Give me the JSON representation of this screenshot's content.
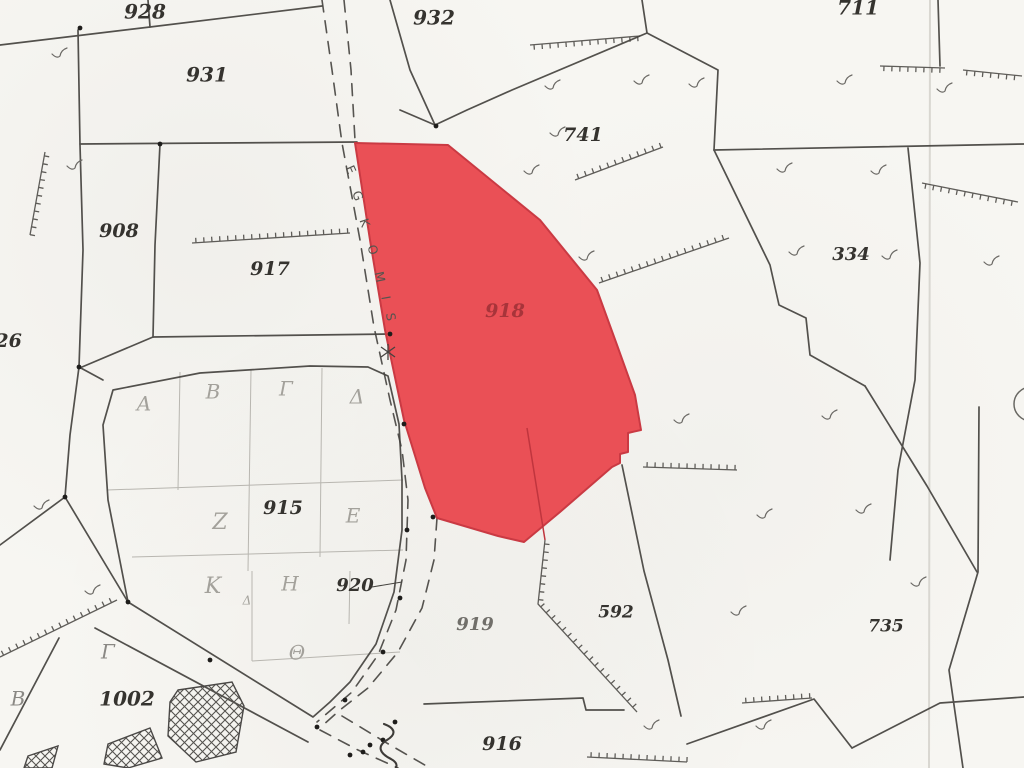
{
  "map": {
    "width": 1024,
    "height": 768,
    "colors": {
      "paper": "#f7f6f2",
      "line": "#45433f",
      "faint": "#b8b6b0",
      "red_fill": "#ea4b52",
      "red_stroke": "#c9353e",
      "red_label": "#a8343a",
      "greek": "#a3a19b",
      "greek_dark": "#8a8884",
      "road_text": "#56544f",
      "fold": "#d9d7d1",
      "mark": "#6b6965",
      "monument": "#1e1d1b"
    },
    "fold_x": 930,
    "highlight": {
      "label": "918",
      "label_pos": [
        505,
        312
      ],
      "points": [
        [
          355,
          143
        ],
        [
          448,
          145
        ],
        [
          540,
          220
        ],
        [
          597,
          290
        ],
        [
          617,
          345
        ],
        [
          635,
          395
        ],
        [
          641,
          430
        ],
        [
          628,
          433
        ],
        [
          628,
          452
        ],
        [
          620,
          454
        ],
        [
          620,
          463
        ],
        [
          612,
          467
        ],
        [
          560,
          512
        ],
        [
          524,
          542
        ],
        [
          498,
          536
        ],
        [
          437,
          518
        ],
        [
          425,
          488
        ],
        [
          404,
          420
        ],
        [
          385,
          330
        ],
        [
          370,
          240
        ]
      ],
      "inner_line": [
        [
          527,
          428
        ],
        [
          545,
          540
        ]
      ]
    },
    "road_name": {
      "text": "EGKOMIS",
      "letters": [
        [
          "E",
          350,
          170,
          66
        ],
        [
          "G",
          357,
          196,
          69
        ],
        [
          "K",
          364,
          223,
          72
        ],
        [
          "O",
          372,
          250,
          75
        ],
        [
          "M",
          379,
          277,
          78
        ],
        [
          "I",
          385,
          298,
          80
        ],
        [
          "S",
          390,
          317,
          82
        ]
      ]
    },
    "labels": [
      {
        "t": "928",
        "x": 145,
        "y": 13,
        "s": 20
      },
      {
        "t": "931",
        "x": 207,
        "y": 76,
        "s": 20
      },
      {
        "t": "932",
        "x": 434,
        "y": 19,
        "s": 20
      },
      {
        "t": "711",
        "x": 858,
        "y": 9,
        "s": 20
      },
      {
        "t": "741",
        "x": 583,
        "y": 136,
        "s": 19
      },
      {
        "t": "334",
        "x": 851,
        "y": 255,
        "s": 18
      },
      {
        "t": "908",
        "x": 119,
        "y": 232,
        "s": 19
      },
      {
        "t": "917",
        "x": 270,
        "y": 270,
        "s": 19
      },
      {
        "t": "326",
        "x": 2,
        "y": 342,
        "s": 19
      },
      {
        "t": "915",
        "x": 283,
        "y": 509,
        "s": 19
      },
      {
        "t": "920",
        "x": 355,
        "y": 586,
        "s": 18
      },
      {
        "t": "919",
        "x": 475,
        "y": 625,
        "s": 18,
        "c": "#716f6a"
      },
      {
        "t": "592",
        "x": 616,
        "y": 613,
        "s": 17
      },
      {
        "t": "916",
        "x": 502,
        "y": 745,
        "s": 19
      },
      {
        "t": "735",
        "x": 886,
        "y": 627,
        "s": 17
      },
      {
        "t": "1002",
        "x": 127,
        "y": 700,
        "s": 20
      }
    ],
    "greek": [
      {
        "t": "Α",
        "x": 144,
        "y": 405,
        "s": 20
      },
      {
        "t": "Β",
        "x": 213,
        "y": 393,
        "s": 20
      },
      {
        "t": "Γ",
        "x": 286,
        "y": 390,
        "s": 20
      },
      {
        "t": "Δ",
        "x": 357,
        "y": 398,
        "s": 20
      },
      {
        "t": "Ζ",
        "x": 220,
        "y": 523,
        "s": 22
      },
      {
        "t": "Ε",
        "x": 353,
        "y": 517,
        "s": 20
      },
      {
        "t": "Κ",
        "x": 213,
        "y": 587,
        "s": 22
      },
      {
        "t": "Η",
        "x": 290,
        "y": 585,
        "s": 20
      },
      {
        "t": "Θ",
        "x": 297,
        "y": 654,
        "s": 20
      },
      {
        "t": "Δ",
        "x": 247,
        "y": 601,
        "s": 12
      },
      {
        "t": "Γ",
        "x": 108,
        "y": 653,
        "s": 20,
        "c": "#8a8884"
      },
      {
        "t": "Β",
        "x": 18,
        "y": 700,
        "s": 20,
        "c": "#8a8884"
      }
    ],
    "boundaries": [
      [
        [
          0,
          45
        ],
        [
          150,
          27
        ],
        [
          322,
          6
        ]
      ],
      [
        [
          148,
          0
        ],
        [
          150,
          27
        ]
      ],
      [
        [
          80,
          144
        ],
        [
          357,
          142
        ]
      ],
      [
        [
          78,
          30
        ],
        [
          80,
          145
        ],
        [
          83,
          250
        ],
        [
          79,
          367
        ],
        [
          70,
          435
        ],
        [
          65,
          497
        ]
      ],
      [
        [
          160,
          144
        ],
        [
          155,
          245
        ],
        [
          153,
          337
        ]
      ],
      [
        [
          153,
          337
        ],
        [
          82,
          367
        ]
      ],
      [
        [
          153,
          337
        ],
        [
          390,
          334
        ]
      ],
      [
        [
          390,
          0
        ],
        [
          410,
          70
        ],
        [
          435,
          125
        ]
      ],
      [
        [
          400,
          110
        ],
        [
          435,
          125
        ],
        [
          467,
          110
        ],
        [
          512,
          90
        ],
        [
          647,
          33
        ]
      ],
      [
        [
          642,
          0
        ],
        [
          647,
          33
        ]
      ],
      [
        [
          647,
          33
        ],
        [
          718,
          70
        ],
        [
          714,
          150
        ]
      ],
      [
        [
          714,
          150
        ],
        [
          1024,
          144
        ]
      ],
      [
        [
          714,
          150
        ],
        [
          770,
          265
        ],
        [
          779,
          305
        ],
        [
          806,
          318
        ],
        [
          810,
          355
        ],
        [
          865,
          386
        ]
      ],
      [
        [
          908,
          148
        ],
        [
          920,
          263
        ],
        [
          915,
          380
        ],
        [
          898,
          470
        ],
        [
          890,
          560
        ]
      ],
      [
        [
          938,
          0
        ],
        [
          940,
          66
        ]
      ],
      [
        [
          865,
          386
        ],
        [
          927,
          486
        ],
        [
          977,
          572
        ]
      ],
      [
        [
          979,
          407
        ],
        [
          978,
          572
        ],
        [
          949,
          670
        ],
        [
          963,
          768
        ]
      ],
      [
        [
          308,
          742
        ],
        [
          95,
          628
        ]
      ],
      [
        [
          59,
          638
        ],
        [
          0,
          750
        ]
      ],
      [
        [
          65,
          497
        ],
        [
          0,
          545
        ]
      ],
      [
        [
          65,
          497
        ],
        [
          128,
          602
        ]
      ],
      [
        [
          424,
          704
        ],
        [
          583,
          698
        ],
        [
          586,
          710
        ],
        [
          624,
          710
        ]
      ],
      [
        [
          622,
          465
        ],
        [
          644,
          571
        ],
        [
          668,
          660
        ],
        [
          681,
          716
        ]
      ],
      [
        [
          687,
          744
        ],
        [
          814,
          699
        ],
        [
          852,
          748
        ]
      ],
      [
        [
          852,
          748
        ],
        [
          940,
          703
        ],
        [
          1024,
          697
        ]
      ],
      [
        [
          79,
          367
        ],
        [
          103,
          380
        ]
      ]
    ],
    "closed": [
      [
        [
          113,
          390
        ],
        [
          200,
          373
        ],
        [
          310,
          366
        ],
        [
          368,
          367
        ],
        [
          388,
          376
        ],
        [
          399,
          424
        ],
        [
          402,
          480
        ],
        [
          402,
          530
        ],
        [
          394,
          592
        ],
        [
          376,
          644
        ],
        [
          350,
          682
        ],
        [
          330,
          702
        ],
        [
          313,
          717
        ],
        [
          128,
          602
        ],
        [
          108,
          500
        ],
        [
          103,
          425
        ]
      ]
    ],
    "dashed": [
      [
        [
          322,
          0
        ],
        [
          332,
          70
        ],
        [
          342,
          143
        ],
        [
          360,
          240
        ],
        [
          374,
          327
        ],
        [
          390,
          400
        ],
        [
          402,
          450
        ],
        [
          408,
          500
        ],
        [
          406,
          560
        ],
        [
          396,
          610
        ],
        [
          378,
          655
        ],
        [
          352,
          692
        ],
        [
          317,
          722
        ]
      ],
      [
        [
          344,
          0
        ],
        [
          351,
          70
        ],
        [
          355,
          140
        ]
      ],
      [
        [
          437,
          518
        ],
        [
          434,
          560
        ],
        [
          422,
          608
        ],
        [
          398,
          652
        ],
        [
          368,
          688
        ],
        [
          340,
          710
        ],
        [
          322,
          726
        ]
      ],
      [
        [
          320,
          730
        ],
        [
          358,
          750
        ],
        [
          398,
          768
        ]
      ],
      [
        [
          342,
          716
        ],
        [
          385,
          742
        ],
        [
          430,
          768
        ]
      ]
    ],
    "grid": [
      [
        [
          180,
          372
        ],
        [
          178,
          490
        ]
      ],
      [
        [
          251,
          370
        ],
        [
          248,
          571
        ]
      ],
      [
        [
          322,
          368
        ],
        [
          320,
          557
        ]
      ],
      [
        [
          252,
          571
        ],
        [
          252,
          661
        ]
      ],
      [
        [
          350,
          571
        ],
        [
          349,
          624
        ]
      ],
      [
        [
          107,
          490
        ],
        [
          403,
          480
        ]
      ],
      [
        [
          132,
          557
        ],
        [
          403,
          550
        ]
      ],
      [
        [
          252,
          661
        ],
        [
          400,
          652
        ]
      ]
    ],
    "leader": [
      [
        372,
        587
      ],
      [
        402,
        582
      ]
    ],
    "ticked": [
      {
        "pts": [
          [
            45,
            152
          ],
          [
            30,
            235
          ]
        ],
        "side": 1
      },
      {
        "pts": [
          [
            192,
            243
          ],
          [
            350,
            233
          ]
        ],
        "side": 1
      },
      {
        "pts": [
          [
            530,
            45
          ],
          [
            640,
            36
          ]
        ],
        "side": -1
      },
      {
        "pts": [
          [
            575,
            180
          ],
          [
            663,
            147
          ]
        ],
        "side": 1
      },
      {
        "pts": [
          [
            599,
            283
          ],
          [
            729,
            238
          ]
        ],
        "side": 1
      },
      {
        "pts": [
          [
            880,
            66
          ],
          [
            945,
            68
          ]
        ],
        "side": -1
      },
      {
        "pts": [
          [
            963,
            70
          ],
          [
            1022,
            76
          ]
        ],
        "side": -1
      },
      {
        "pts": [
          [
            922,
            183
          ],
          [
            1018,
            202
          ]
        ],
        "side": -1
      },
      {
        "pts": [
          [
            643,
            467
          ],
          [
            737,
            470
          ]
        ],
        "side": 1
      },
      {
        "pts": [
          [
            545,
            540
          ],
          [
            538,
            604
          ],
          [
            637,
            712
          ]
        ],
        "side": 1
      },
      {
        "pts": [
          [
            742,
            703
          ],
          [
            812,
            698
          ]
        ],
        "side": 1
      },
      {
        "pts": [
          [
            587,
            757
          ],
          [
            687,
            762
          ]
        ],
        "side": 1
      },
      {
        "pts": [
          [
            0,
            657
          ],
          [
            117,
            600
          ]
        ],
        "side": 1
      }
    ],
    "scrub": [
      [
        60,
        55
      ],
      [
        75,
        167
      ],
      [
        532,
        172
      ],
      [
        558,
        134
      ],
      [
        642,
        82
      ],
      [
        697,
        85
      ],
      [
        845,
        82
      ],
      [
        945,
        90
      ],
      [
        553,
        87
      ],
      [
        785,
        170
      ],
      [
        879,
        172
      ],
      [
        797,
        253
      ],
      [
        890,
        257
      ],
      [
        992,
        263
      ],
      [
        830,
        417
      ],
      [
        765,
        516
      ],
      [
        864,
        511
      ],
      [
        919,
        584
      ],
      [
        739,
        613
      ],
      [
        652,
        727
      ],
      [
        764,
        727
      ],
      [
        682,
        421
      ],
      [
        587,
        258
      ],
      [
        93,
        592
      ],
      [
        42,
        507
      ]
    ],
    "monuments": [
      [
        80,
        28
      ],
      [
        160,
        144
      ],
      [
        390,
        334
      ],
      [
        404,
        424
      ],
      [
        407,
        530
      ],
      [
        400,
        598
      ],
      [
        383,
        652
      ],
      [
        345,
        700
      ],
      [
        317,
        727
      ],
      [
        128,
        602
      ],
      [
        210,
        660
      ],
      [
        395,
        722
      ],
      [
        383,
        740
      ],
      [
        363,
        752
      ],
      [
        433,
        517
      ],
      [
        65,
        497
      ],
      [
        79,
        367
      ],
      [
        436,
        126
      ],
      [
        370,
        745
      ],
      [
        350,
        755
      ]
    ],
    "buildings": [
      [
        [
          178,
          690
        ],
        [
          232,
          682
        ],
        [
          244,
          706
        ],
        [
          236,
          752
        ],
        [
          196,
          762
        ],
        [
          168,
          736
        ],
        [
          170,
          702
        ]
      ],
      [
        [
          108,
          744
        ],
        [
          150,
          728
        ],
        [
          162,
          758
        ],
        [
          128,
          768
        ],
        [
          104,
          764
        ]
      ],
      [
        [
          28,
          756
        ],
        [
          58,
          746
        ],
        [
          52,
          768
        ],
        [
          24,
          768
        ]
      ]
    ],
    "symbols": {
      "circle": [
        1031,
        404,
        17
      ],
      "asterisk": [
        388,
        352
      ],
      "squiggle": [
        388,
        724
      ]
    }
  }
}
